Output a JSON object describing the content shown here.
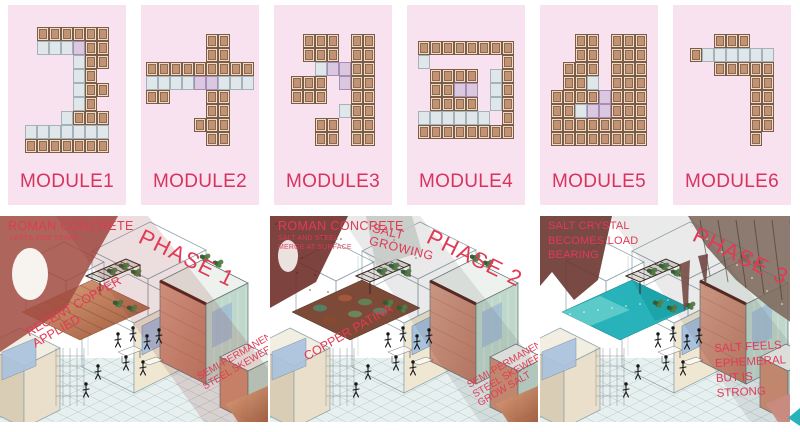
{
  "modules": [
    {
      "label": "MODULE1",
      "plan": [
        ".######",
        ".+++*##",
        "....+##",
        "....+#.",
        "....+##",
        "....+#.",
        "...+###",
        "+++++++",
        "#######"
      ]
    },
    {
      "label": "MODULE2",
      "plan": [
        ".....##..",
        ".....##..",
        "#########",
        "++++**+++",
        "##...##..",
        ".....##..",
        "....###..",
        ".....##.."
      ]
    },
    {
      "label": "MODULE3",
      "plan": [
        ".###.##",
        ".###.##",
        "..+**##",
        "###.*##",
        "###..##",
        "....+##",
        "..##.##",
        "..##.##"
      ]
    },
    {
      "label": "MODULE4",
      "plan": [
        "########",
        "+......#",
        ".####.+#",
        ".##**.+#",
        ".####.+#",
        "++++++.#",
        "########"
      ]
    },
    {
      "label": "MODULE5",
      "plan": [
        "..##.###",
        "..##.###",
        ".###.###",
        ".##+.###",
        "####*###",
        "##+**###",
        "########",
        "########"
      ]
    },
    {
      "label": "MODULE6",
      "plan": [
        "..###..",
        "#++++++",
        "..#####",
        ".....##",
        ".....##",
        ".....##",
        ".....##",
        ".....#."
      ]
    }
  ],
  "phases": [
    {
      "label": "PHASE 1",
      "notes": {
        "title": "ROMAN CONCRETE",
        "sub1": "LASTS 2000 YEARS",
        "diag1": "RECENT COPPER",
        "diag2": "APPLIED",
        "right1": "SEMI-PERMANENT",
        "right2": "STEEL SKEWERS"
      }
    },
    {
      "label": "PHASE 2",
      "notes": {
        "title": "ROMAN CONCRETE",
        "sub1": "SALT AND STEEL",
        "sub2": "MERGE AT SURFACE",
        "top1": "SALT",
        "top2": "GROWING",
        "diag1": "COPPER PATINA",
        "right1": "SEMI-PERMANENT",
        "right2": "STEEL SKEWERS",
        "right3": "GROW SALT"
      }
    },
    {
      "label": "PHASE 3",
      "notes": {
        "t1": "SALT CRYSTAL",
        "t2": "BECOMES LOAD",
        "t3": "BEARING",
        "right1": "SALT FEELS",
        "right2": "EPHEMERAL",
        "right3": "BUT IS",
        "right4": "STRONG"
      }
    }
  ],
  "colors": {
    "accent_red": "#e23a55",
    "module_label": "#d6335f",
    "panel_pink": "#f9e2ef",
    "copper_light": "#dda37e",
    "copper_dark": "#a05a3c",
    "patina_base": "#7c4a36",
    "patina_green": "#4f8a6e",
    "patina_rust": "#a85a3c",
    "salt_teal": "#27b3b9",
    "salt_light": "#7fd8d4",
    "salt_dark": "#13969c",
    "floor_fill": "#e7f0ef",
    "floor_line": "#a9c6c9",
    "line": "#8aa0aa",
    "maroon": "#a04a40",
    "maroon_dark": "#6e2f2a",
    "crag_gray": "#7d685c",
    "glass": "#bfd8cb",
    "window_blue": "#a9c2de",
    "plant_dark": "#3c6b38",
    "plant_light": "#557f46",
    "salmon": "#d18f72",
    "salmon_dark": "#c07a62"
  }
}
